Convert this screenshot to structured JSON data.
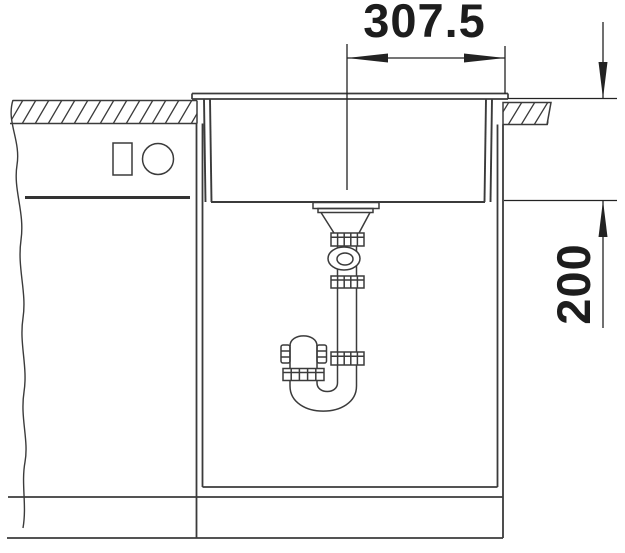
{
  "drawing": {
    "dimension_width": {
      "value": "307.5",
      "unit_note": ""
    },
    "dimension_depth": {
      "value": "200",
      "unit_note": ""
    },
    "colors": {
      "background": "#ffffff",
      "line": "#3b3b3b",
      "dimension": "#232323",
      "text": "#1d1d1d"
    }
  }
}
